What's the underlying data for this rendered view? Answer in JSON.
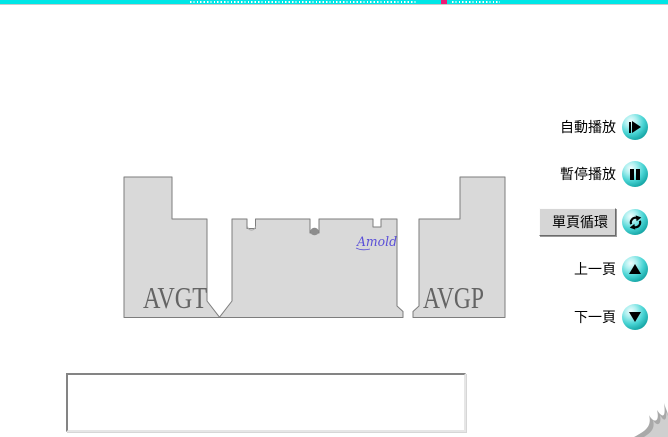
{
  "theme": {
    "bg": "#ffffff",
    "progress-cyan": "#00e6e6",
    "progress-line": "#c9c9c9",
    "marker-pink": "#ee1b76",
    "tick-white": "#ffffff",
    "diagram-fill": "#d9d9d9",
    "diagram-line": "#7d7d7d",
    "diagram-label-gray": "#646464",
    "brand-blue": "#5a4fd8",
    "button-teal-dark": "#0b6b6b",
    "icon-black": "#000000",
    "swoosh-gray": "#a9a9a9"
  },
  "progress_bar": {
    "marker_color": "#ee1b76",
    "tick_color": "#ffffff"
  },
  "diagram": {
    "plate_left_label": "AVGT",
    "plate_right_label": "AVGP",
    "brand_signature": "Amold"
  },
  "controls": {
    "items": [
      {
        "label": "自動播放",
        "icon": "play-icon",
        "active": false
      },
      {
        "label": "暫停播放",
        "icon": "pause-icon",
        "active": false
      },
      {
        "label": "單頁循環",
        "icon": "loop-icon",
        "active": true
      },
      {
        "label": "上一頁",
        "icon": "up-icon",
        "active": false
      },
      {
        "label": "下一頁",
        "icon": "down-icon",
        "active": false
      }
    ]
  },
  "caption_box": {
    "text": ""
  }
}
